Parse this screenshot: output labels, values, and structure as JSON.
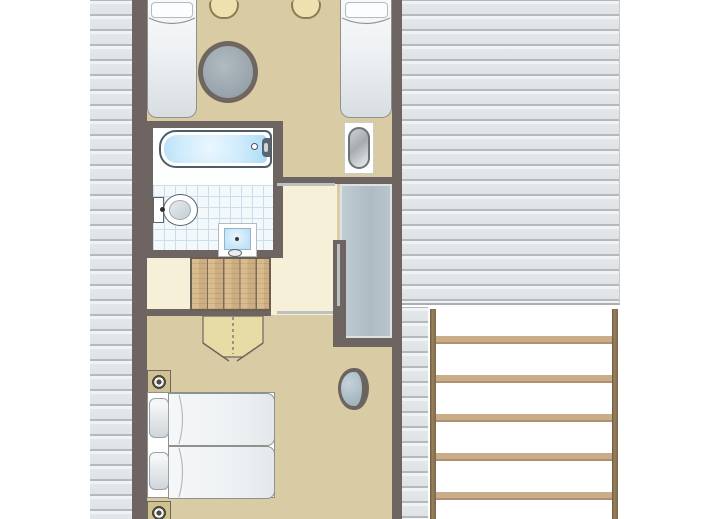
{
  "meta": {
    "type": "architectural-floor-plan",
    "title": "Upper floor plan of cottage",
    "orientation": "top-down",
    "canvas": {
      "width_px": 713,
      "height_px": 519
    }
  },
  "palette": {
    "wall": "#6e6461",
    "floor_tan": "#d9cca4",
    "floor_cream": "#f7f0d8",
    "roof_shingle": "#e7eaec",
    "roof_shingle_line": "#b3b9bd",
    "roof_edge": "#a9aeb2",
    "stair_wood": "#d5b78a",
    "stair_wood_line": "#7b6c59",
    "arrow_wood": "#e8dca6",
    "arrow_line": "#6f665f",
    "table_ring": "#6f6660",
    "table_fill": "#9aa5ad",
    "tub_blue": "#cdeafb",
    "fixture_outline": "#4f5d68",
    "tile_bg": "#f3f8fb",
    "tile_line": "#cadded",
    "wardrobe": "#b5c2c9",
    "wardrobe_border": "#dde2e3",
    "ladder_rail": "#8d7453",
    "ladder_rung": "#c9ad88",
    "bed_white": "#f8f9fa",
    "basin_fill": "#a2b4c0",
    "door_leaf": "#bec1c1",
    "chair_tan": "#eee0af",
    "lamp_base": "#d0c191"
  },
  "elements": {
    "plan_title": "Upper floor plan",
    "top_bedroom": "Bedroom with two single beds, round table and two chairs",
    "bathroom": "Bathroom with bathtub, toilet and washbasin",
    "toilet_room": "Toilet in corner niche",
    "landing": "Landing with staircase going down",
    "wardrobe": "Built-in wardrobe",
    "lower_bedroom": "Bedroom with double bed, washbasin and bedside lamps",
    "roof_left": "Sloped roof surface (left)",
    "roof_right": "Sloped roof surface (right)",
    "ladder": "Exterior ladder / trellis"
  },
  "furniture": [
    {
      "room": "top_bedroom",
      "items": [
        "single-bed-left",
        "single-bed-right",
        "round-table",
        "chair-1",
        "chair-2"
      ]
    },
    {
      "room": "bathroom",
      "items": [
        "bathtub",
        "toilet",
        "washbasin-sink"
      ]
    },
    {
      "room": "toilet_room",
      "items": [
        "toilet-pan"
      ]
    },
    {
      "room": "landing",
      "items": [
        "staircase",
        "stair-direction-arrow",
        "door-leaf-top",
        "door-leaf-side",
        "door-leaf-bottom"
      ]
    },
    {
      "room": "lower_bedroom",
      "items": [
        "double-bed",
        "pillow-1",
        "pillow-2",
        "bedside-lamp-1",
        "bedside-lamp-2",
        "washbasin"
      ]
    }
  ],
  "ladder": {
    "rungs": 5,
    "rails": 2
  }
}
